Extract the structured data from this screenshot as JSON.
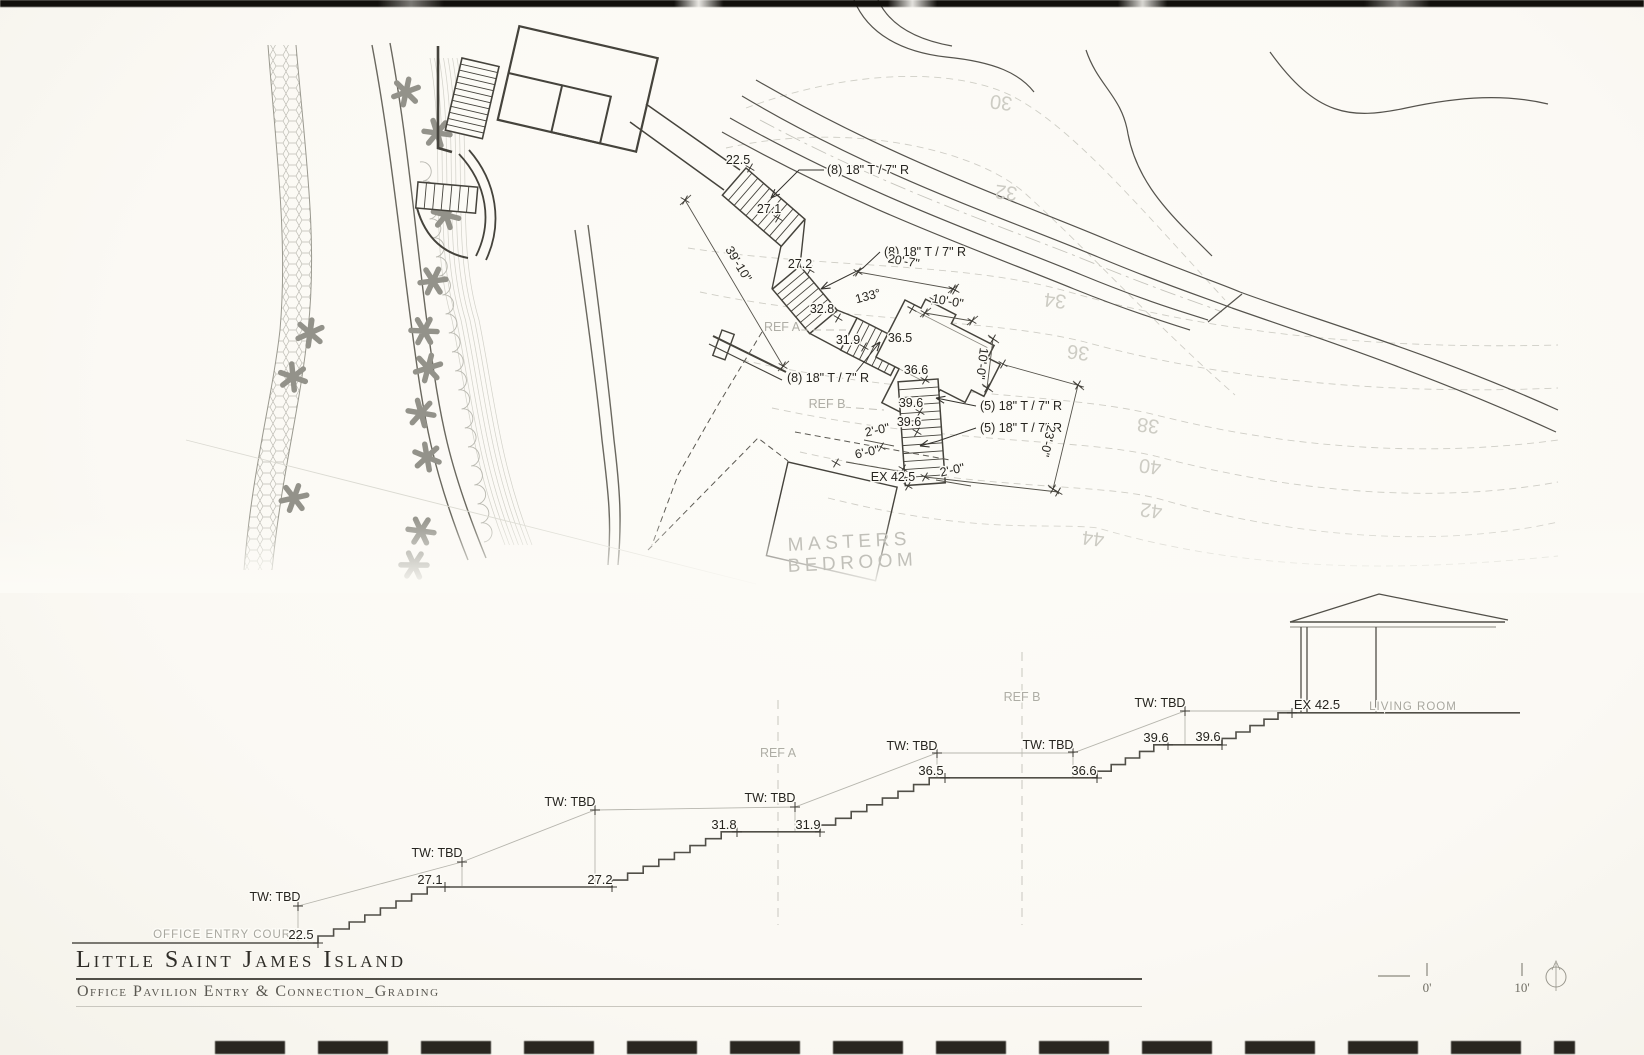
{
  "document": {
    "title": "Little Saint James Island",
    "subtitle": "Office Pavilion Entry & Connection_Grading"
  },
  "colors": {
    "ink": "#45433c",
    "annotation": "#26241f",
    "gray_label": "#aeada5",
    "contour": "#cdccc4",
    "paper": "#fcfbf6"
  },
  "plan": {
    "annotations": [
      {
        "t": "22.5",
        "x": 738,
        "y": 164
      },
      {
        "t": "(8) 18\" T / 7\" R",
        "x": 827,
        "y": 174,
        "a": "start"
      },
      {
        "t": "27.1",
        "x": 769,
        "y": 213
      },
      {
        "t": "27.2",
        "x": 800,
        "y": 268
      },
      {
        "t": "(8) 18\" T / 7\" R",
        "x": 884,
        "y": 256,
        "a": "start"
      },
      {
        "t": "32.8",
        "x": 822,
        "y": 313
      },
      {
        "t": "133°",
        "x": 869,
        "y": 300,
        "r": -15,
        "i": true
      },
      {
        "t": "31.9",
        "x": 848,
        "y": 344
      },
      {
        "t": "36.5",
        "x": 900,
        "y": 342
      },
      {
        "t": "(8) 18\" T / 7\" R",
        "x": 787,
        "y": 382,
        "a": "start"
      },
      {
        "t": "36.6",
        "x": 916,
        "y": 374
      },
      {
        "t": "39.6",
        "x": 911,
        "y": 407
      },
      {
        "t": "39.6",
        "x": 909,
        "y": 426
      },
      {
        "t": "(5) 18\" T / 7\" R",
        "x": 980,
        "y": 410,
        "a": "start"
      },
      {
        "t": "(5) 18\" T / 7\" R",
        "x": 980,
        "y": 432,
        "a": "start"
      },
      {
        "t": "2'-0\"",
        "x": 878,
        "y": 434,
        "r": -12
      },
      {
        "t": "6'-0\"",
        "x": 868,
        "y": 456,
        "r": -12
      },
      {
        "t": "EX 42.5",
        "x": 893,
        "y": 481
      },
      {
        "t": "2'-0\"",
        "x": 953,
        "y": 474,
        "r": -12
      },
      {
        "t": "39'-10\"",
        "x": 735,
        "y": 266,
        "r": 59
      },
      {
        "t": "20'-7\"",
        "x": 903,
        "y": 265,
        "r": 10
      },
      {
        "t": "10'-0\"",
        "x": 947,
        "y": 305,
        "r": 10
      },
      {
        "t": "10'-0\"",
        "x": 978,
        "y": 363,
        "r": 97
      },
      {
        "t": "23'-0\"",
        "x": 1044,
        "y": 440,
        "r": 103
      }
    ],
    "ref_labels": [
      {
        "t": "REF A",
        "x": 782,
        "y": 331
      },
      {
        "t": "REF B",
        "x": 827,
        "y": 408
      }
    ],
    "room_label": [
      {
        "t": "MASTERS",
        "x": 788,
        "y": 551,
        "a": "start",
        "r": -3
      },
      {
        "t": "BEDROOM",
        "x": 788,
        "y": 572,
        "a": "start",
        "r": -3
      }
    ],
    "contour_labels": [
      {
        "t": "30",
        "x": 1002,
        "y": 96,
        "r": 187
      },
      {
        "t": "32",
        "x": 1007,
        "y": 186,
        "r": 187
      },
      {
        "t": "34",
        "x": 1056,
        "y": 294,
        "r": 187
      },
      {
        "t": "36",
        "x": 1079,
        "y": 346,
        "r": 187
      },
      {
        "t": "38",
        "x": 1149,
        "y": 419,
        "r": 187
      },
      {
        "t": "40",
        "x": 1151,
        "y": 460,
        "r": 187
      },
      {
        "t": "42",
        "x": 1152,
        "y": 504,
        "r": 187
      },
      {
        "t": "44",
        "x": 1094,
        "y": 532,
        "r": 187
      }
    ]
  },
  "section": {
    "spot_elevations": [
      {
        "t": "22.5",
        "x": 301,
        "y": 939
      },
      {
        "t": "27.1",
        "x": 430,
        "y": 884
      },
      {
        "t": "27.2",
        "x": 600,
        "y": 884
      },
      {
        "t": "31.8",
        "x": 724,
        "y": 829
      },
      {
        "t": "31.9",
        "x": 808,
        "y": 829
      },
      {
        "t": "36.5",
        "x": 931,
        "y": 775
      },
      {
        "t": "36.6",
        "x": 1084,
        "y": 775
      },
      {
        "t": "39.6",
        "x": 1156,
        "y": 742
      },
      {
        "t": "39.6",
        "x": 1208,
        "y": 741
      },
      {
        "t": "EX 42.5",
        "x": 1317,
        "y": 709
      }
    ],
    "tw_labels": [
      {
        "t": "TW: TBD",
        "x": 275,
        "y": 901
      },
      {
        "t": "TW: TBD",
        "x": 437,
        "y": 857
      },
      {
        "t": "TW: TBD",
        "x": 570,
        "y": 806
      },
      {
        "t": "TW: TBD",
        "x": 770,
        "y": 802
      },
      {
        "t": "TW: TBD",
        "x": 912,
        "y": 750
      },
      {
        "t": "TW: TBD",
        "x": 1048,
        "y": 749
      },
      {
        "t": "TW: TBD",
        "x": 1160,
        "y": 707
      }
    ],
    "area_labels": [
      {
        "t": "OFFICE ENTRY COURT",
        "x": 226,
        "y": 938
      },
      {
        "t": "LIVING ROOM",
        "x": 1413,
        "y": 710
      }
    ],
    "ref_labels": [
      {
        "t": "REF A",
        "x": 778,
        "y": 757
      },
      {
        "t": "REF B",
        "x": 1022,
        "y": 701
      }
    ]
  },
  "scale_bar": {
    "labels": [
      {
        "t": "0'",
        "x": 1427,
        "y": 992
      },
      {
        "t": "10'",
        "x": 1522,
        "y": 992
      }
    ]
  }
}
